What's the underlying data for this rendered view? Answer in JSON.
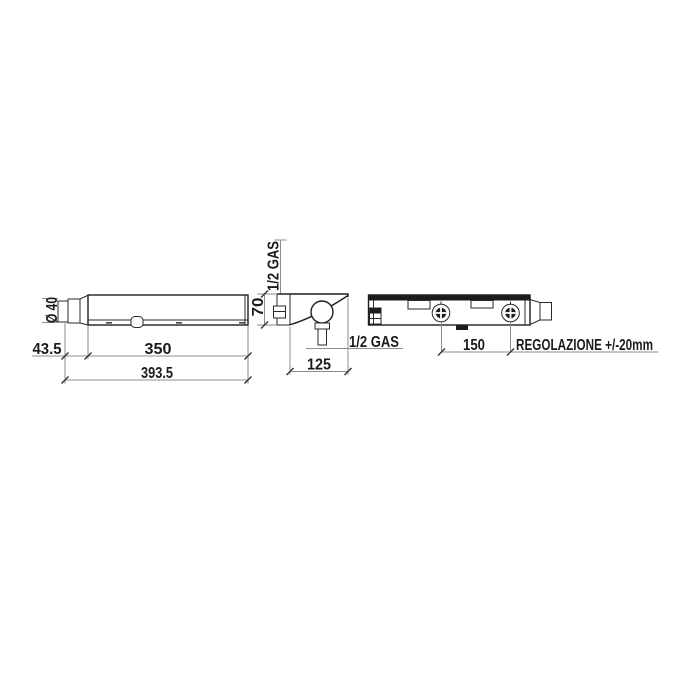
{
  "drawing": {
    "front_view": {
      "diameter": "Ø 40",
      "cap_offset": "43.5",
      "body_length": "350",
      "total_length": "393.5"
    },
    "side_view": {
      "top_connection": "1/2 GAS",
      "height": "70",
      "depth": "125",
      "outlet_connection": "1/2 GAS"
    },
    "rear_view": {
      "inlet_spacing": "150",
      "adjustment_note": "REGOLAZIONE +/-20mm"
    }
  },
  "colors": {
    "line": "#1e1e1e",
    "dimension_line": "#8d8d8d",
    "background": "#ffffff"
  }
}
